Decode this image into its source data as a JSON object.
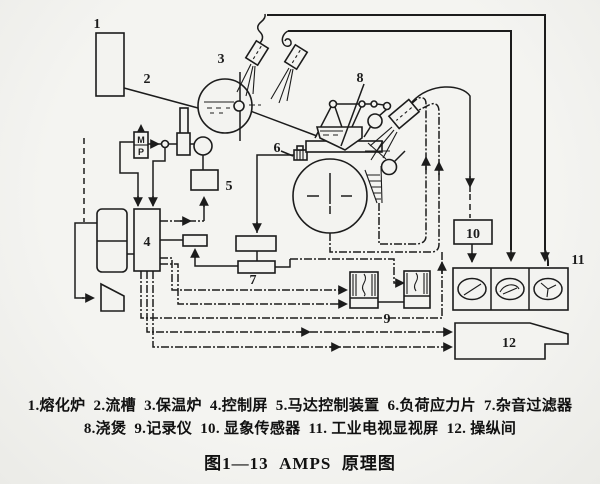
{
  "figure": {
    "caption": "图1—13  AMPS  原理图"
  },
  "legend": {
    "line1": "1.熔化炉  2.流槽  3.保温炉  4.控制屏  5.马达控制装置  6.负荷应力片  7.杂音过滤器",
    "line2": "8.浇煲  9.记录仪  10. 显象传感器  11. 工业电视显视屏  12. 操纵间"
  },
  "components": [
    {
      "id": 1,
      "label": "1",
      "name": "熔化炉"
    },
    {
      "id": 2,
      "label": "2",
      "name": "流槽"
    },
    {
      "id": 3,
      "label": "3",
      "name": "保温炉"
    },
    {
      "id": 4,
      "label": "4",
      "name": "控制屏"
    },
    {
      "id": 5,
      "label": "5",
      "name": "马达控制装置"
    },
    {
      "id": 6,
      "label": "6",
      "name": "负荷应力片"
    },
    {
      "id": 7,
      "label": "7",
      "name": "杂音过滤器"
    },
    {
      "id": 8,
      "label": "8",
      "name": "浇煲"
    },
    {
      "id": 9,
      "label": "9",
      "name": "记录仪"
    },
    {
      "id": 10,
      "label": "10",
      "name": "显象传感器"
    },
    {
      "id": 11,
      "label": "11",
      "name": "工业电视显视屏"
    },
    {
      "id": 12,
      "label": "12",
      "name": "操纵间"
    }
  ],
  "diagram": {
    "labels": {
      "c1": "1",
      "c2": "2",
      "c3": "3",
      "c4": "4",
      "c5": "5",
      "c6": "6",
      "c7": "7",
      "c8": "8",
      "c9": "9",
      "c10": "10",
      "c11": "11",
      "c12": "12"
    },
    "motor": {
      "m": "M",
      "p": "P"
    }
  },
  "colors": {
    "paper": "#f2f2ef",
    "ink": "#1c1c1c"
  }
}
